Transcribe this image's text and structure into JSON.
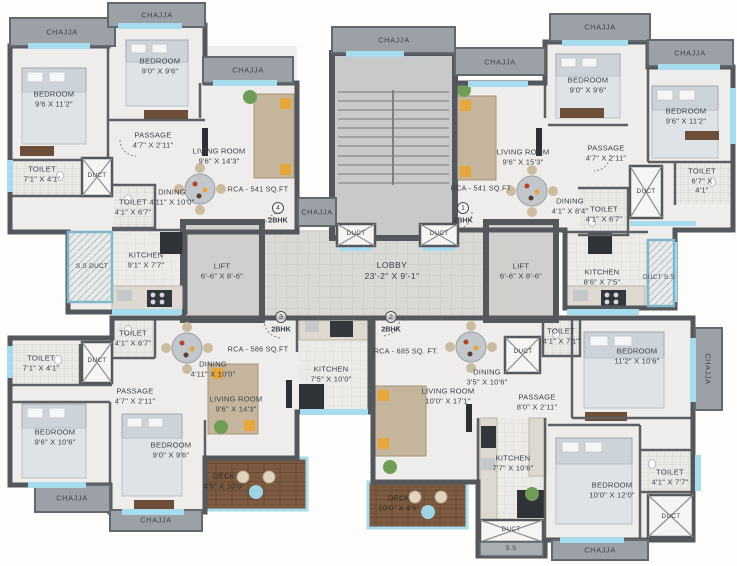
{
  "shared": {
    "chajja": "CHAJJA",
    "duct": "DUCT",
    "ss_duct": "S.S DUCT",
    "duct_ss": "DUCT S.S",
    "ss": "S.S",
    "lift": "LIFT\n6'-6\" X 8'-6\"",
    "lobby": "LOBBY\n23'-2\" X 9'-1\""
  },
  "units": {
    "u4": {
      "number": "4",
      "type": "2BHK",
      "rca": "RCA - 541 SQ.FT",
      "rooms": {
        "bed1": "BEDROOM\n9'6 X 11'2\"",
        "bed2": "BEDROOM\n9'0\" X 9'6\"",
        "passage": "PASSAGE\n4'7\" X 2'11\"",
        "toilet1": "TOILET\n7'1\" X 4'1\"",
        "toilet2": "TOILET\n4'1\" X 6'7\"",
        "living": "LIVING ROOM\n9'6\" X 14'3\"",
        "dining": "DINING\n4'11\" X 10'0\"",
        "kitchen": "KITCHEN\n9'1\" X 7'7\""
      }
    },
    "u1": {
      "number": "1",
      "type": "2BHK",
      "rca": "RCA - 541 SQ.FT",
      "rooms": {
        "living": "LIVING ROOM\n9'6\" X 15'3\"",
        "bed1": "BEDROOM\n9'0\" X 9'6\"",
        "bed2": "BEDROOM\n9'6\" X 11'2\"",
        "passage": "PASSAGE\n4'7\" X 2'11\"",
        "toilet1": "TOILET\n6'7\" X 4'1\"",
        "toilet2": "TOILET\n4'1\" X 6'7\"",
        "dining": "DINING\n4'1\" X 8'4\"",
        "kitchen": "KITCHEN\n8'6\" X 7'5\""
      }
    },
    "u3": {
      "number": "3",
      "type": "2BHK",
      "rca": "RCA - 586 SQ.FT",
      "rooms": {
        "toilet1": "TOILET\n7'1\" X 4'1\"",
        "toilet2": "TOILET\n4'1\" X 6'7\"",
        "passage": "PASSAGE\n4'7\" X 2'11\"",
        "dining": "DINING\n4'11\" X 10'0\"",
        "bed1": "BEDROOM\n9'6\" X 10'6\"",
        "bed2": "BEDROOM\n9'0\" X 9'6\"",
        "living": "LIVING ROOM\n9'6\" X 14'3\"",
        "kitchen": "KITCHEN\n7'5\" X 10'0\"",
        "deck": "DECK\n4'5\" X 10'0\""
      }
    },
    "u2": {
      "number": "2",
      "type": "2BHK",
      "rca": "RCA - 685 SQ. FT.",
      "rooms": {
        "living": "LIVING ROOM\n10'0\" X 17'1\"",
        "dining": "DINING\n3'5\" X 10'6\"",
        "toilet1": "TOILET\n4'1\" X 7'1\"",
        "bed1": "BEDROOM\n11'2\" X 10'6\"",
        "passage": "PASSAGE\n8'0\" X 2'11\"",
        "kitchen": "KITCHEN\n7'7\" X 10'6\"",
        "bed2": "BEDROOM\n10'0\" X 12'0\"",
        "toilet2": "TOILET\n4'1\" X 7'7\"",
        "deck": "DECK\n10'0\" X 4'5\""
      }
    }
  },
  "colors": {
    "wall": "#54575b",
    "chajja": "#9ba1a6",
    "window": "#a6dcee",
    "deck_wood": "#7c5b42",
    "floor": "#eeedeb",
    "lobby_floor": "#dadad8",
    "accent_yellow": "#e7a63a"
  }
}
